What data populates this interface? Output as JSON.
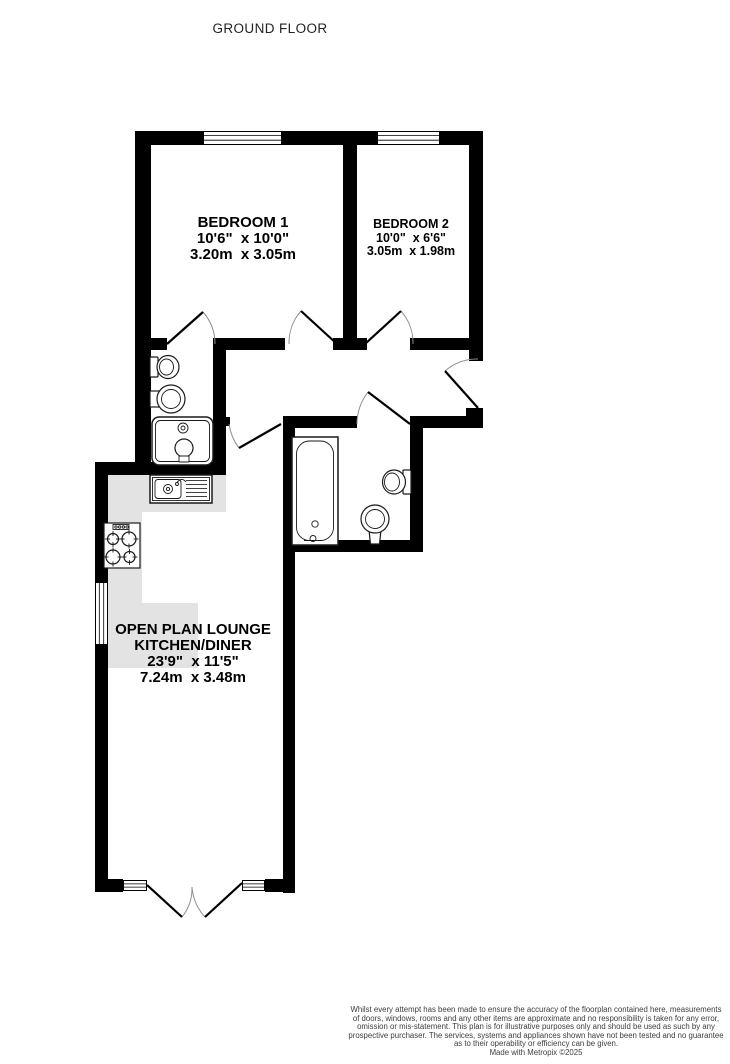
{
  "title": "GROUND FLOOR",
  "colors": {
    "wall": "#000000",
    "counter": "#e3e3e3",
    "fixture_stroke": "#1a1a1a",
    "door_leaf": "#000000",
    "door_arc": "#8f8f8f",
    "label_text": "#000000",
    "footer_text": "#3d3d3d"
  },
  "rooms": {
    "bedroom1": {
      "name": "BEDROOM 1",
      "size_imperial": "10'6\"  x 10'0\"",
      "size_metric": "3.20m  x 3.05m"
    },
    "bedroom2": {
      "name": "BEDROOM 2",
      "size_imperial": "10'0\"  x 6'6\"",
      "size_metric": "3.05m  x 1.98m"
    },
    "lounge": {
      "name_line1": "OPEN PLAN LOUNGE",
      "name_line2": "KITCHEN/DINER",
      "size_imperial": "23'9\"  x 11'5\"",
      "size_metric": "7.24m  x 3.48m"
    }
  },
  "fixtures": [
    "toilet",
    "wash-basin",
    "shower-tray",
    "kitchen-sink-with-drainer",
    "hob-4-burner",
    "bath",
    "toilet",
    "pedestal-basin"
  ],
  "footer": {
    "lines": [
      "Whilst every attempt has been made to ensure the accuracy of the floorplan contained here, measurements",
      "of doors, windows, rooms and any other items are approximate and no responsibility is taken for any error,",
      "omission or mis-statement. This plan is for illustrative purposes only and should be used as such by any",
      "prospective purchaser. The services, systems and appliances shown have not been tested and no guarantee",
      "as to their operability or efficiency can be given."
    ],
    "credit": "Made with Metropix ©2025"
  }
}
